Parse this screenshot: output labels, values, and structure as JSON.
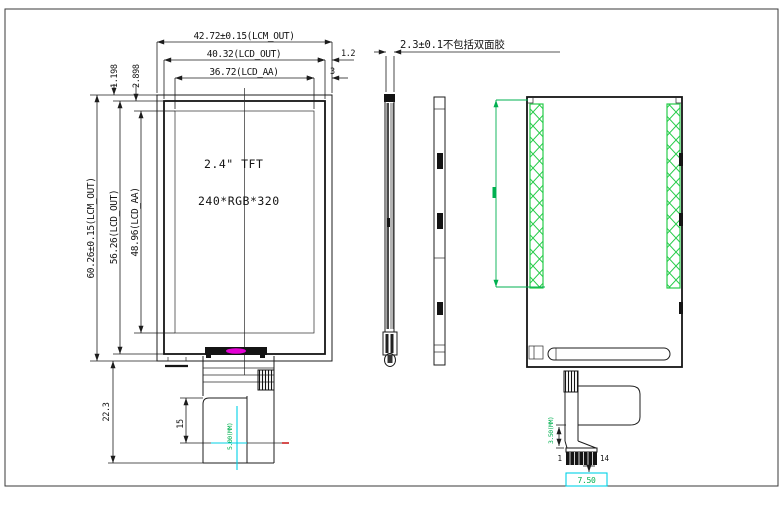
{
  "front": {
    "dim_width_lcm": "42.72±0.15(LCM_OUT)",
    "dim_width_lcd": "40.32(LCD_OUT)",
    "dim_width_aa": "36.72(LCD_AA)",
    "dim_edge_lcd": "1.2",
    "dim_edge_aa": "3",
    "dim_top_offset1": "1.198",
    "dim_top_offset2": "2.898",
    "dim_height_lcm": "60.26±0.15(LCM_OUT)",
    "dim_height_lcd": "56.26(LCD_OUT)",
    "dim_height_aa": "48.96(LCD_AA)",
    "dim_fpc_drop": "22.3",
    "label_size": "2.4\" TFT",
    "label_resolution": "240*RGB*320",
    "dim_fpc_height": "15",
    "dim_fpc_width_note": "5.00(MM)"
  },
  "side": {
    "dim_thickness_note": "2.3±0.1不包括双面胶"
  },
  "back": {
    "dim_fpc_note": "3.50(MM)",
    "dim_connector_width": "7.50",
    "pin_first": "1",
    "pin_last": "14"
  },
  "colors": {
    "annotation_green": "#00B050",
    "tape_hatch_green": "#27CC4A",
    "measure_cyan": "#00D2E6",
    "marker_magenta": "#E400D4",
    "line_black": "#1C1C1C"
  }
}
